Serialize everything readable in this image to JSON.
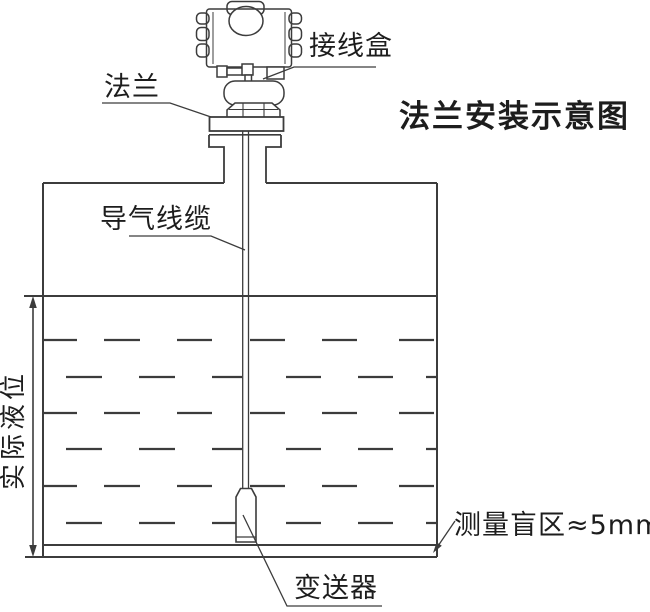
{
  "title": "法兰安装示意图",
  "labels": {
    "junction_box": "接线盒",
    "flange": "法兰",
    "air_guide_cable": "导气线缆",
    "actual_liquid_level": "实际液位",
    "transmitter": "变送器",
    "blind_zone": "测量盲区≈5mm"
  },
  "colors": {
    "line": "#3c3c3c",
    "text": "#1d1d1d",
    "background": "#ffffff"
  }
}
